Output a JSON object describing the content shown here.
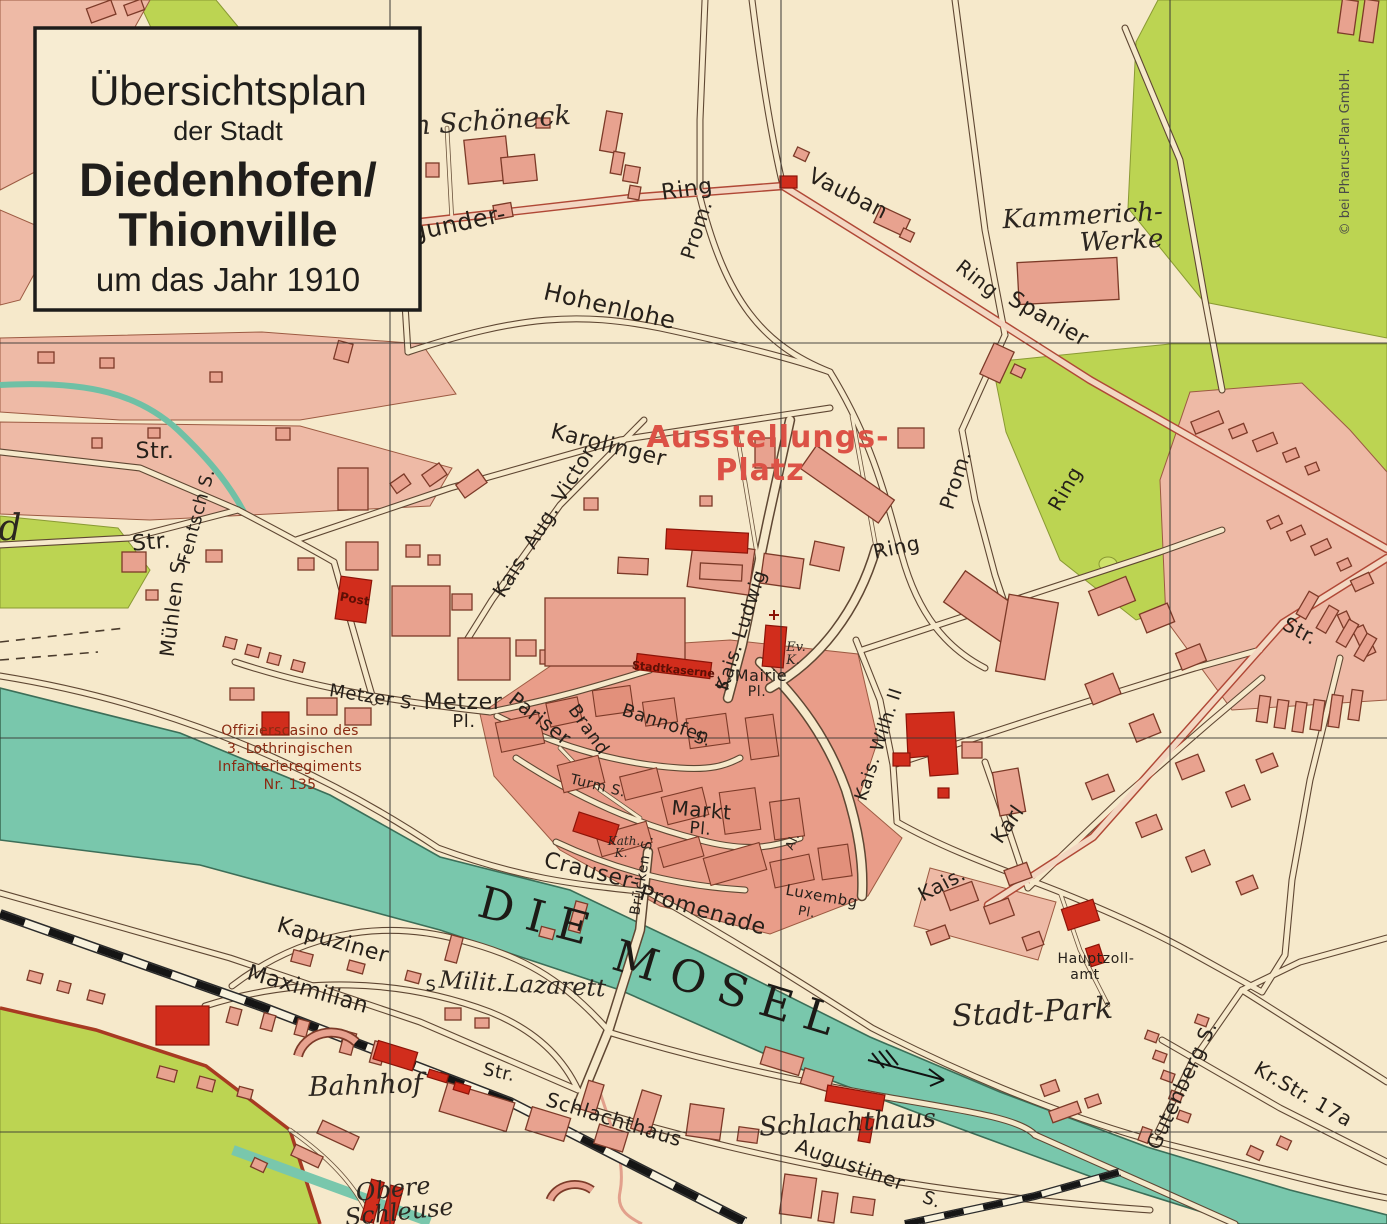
{
  "map_title_box": {
    "line1": "Übersichtsplan",
    "line2": "der Stadt",
    "line3": "Diedenhofen/",
    "line4": "Thionville",
    "line5": "um das Jahr 1910"
  },
  "copyright": "© bei Pharus-Plan GmbH.",
  "colors": {
    "paper": "#f6e9cb",
    "district_pink": "#eebaa6",
    "old_town": "#e99d89",
    "building_salmon": "#e8a28f",
    "building_red": "#d12d1c",
    "park_green": "#bcd452",
    "river_teal": "#79c7ac",
    "main_road_red": "#b04836",
    "red_label": "#dc5246",
    "script_red": "#8a2a12"
  },
  "river_name": "DIE MOSEL",
  "labels": [
    {
      "t": "Im Schöneck",
      "x": 483,
      "y": 130,
      "r": -4,
      "s": 27,
      "st": "se"
    },
    {
      "t": "gunder-",
      "x": 460,
      "y": 231,
      "r": -12,
      "s": 24,
      "st": "st"
    },
    {
      "t": "Ring",
      "x": 688,
      "y": 196,
      "r": -8,
      "s": 22,
      "st": "st"
    },
    {
      "t": "Prom.",
      "x": 703,
      "y": 232,
      "r": -72,
      "s": 20,
      "st": "st"
    },
    {
      "t": "Vauban",
      "x": 845,
      "y": 200,
      "r": 27,
      "s": 22,
      "st": "st"
    },
    {
      "t": "Ring",
      "x": 973,
      "y": 284,
      "r": 38,
      "s": 20,
      "st": "st"
    },
    {
      "t": "Spanier",
      "x": 1045,
      "y": 325,
      "r": 30,
      "s": 22,
      "st": "st"
    },
    {
      "t": "Kammerich-",
      "x": 1083,
      "y": 224,
      "r": -3,
      "s": 26,
      "st": "se"
    },
    {
      "t": "Werke",
      "x": 1122,
      "y": 249,
      "r": -3,
      "s": 26,
      "st": "se"
    },
    {
      "t": "Hohenlohe",
      "x": 608,
      "y": 314,
      "r": 13,
      "s": 24,
      "st": "st"
    },
    {
      "t": "Karolinger",
      "x": 607,
      "y": 452,
      "r": 14,
      "s": 22,
      "st": "st"
    },
    {
      "t": "Kais. Aug. Victor.",
      "x": 551,
      "y": 523,
      "r": -58,
      "s": 20,
      "st": "st"
    },
    {
      "t": "Ausstellungs-",
      "x": 768,
      "y": 447,
      "r": 0,
      "s": 30,
      "st": "rd"
    },
    {
      "t": "Platz",
      "x": 760,
      "y": 480,
      "r": 0,
      "s": 30,
      "st": "rd"
    },
    {
      "t": "Prom.",
      "x": 962,
      "y": 482,
      "r": -72,
      "s": 20,
      "st": "st"
    },
    {
      "t": "Ring",
      "x": 898,
      "y": 554,
      "r": -12,
      "s": 20,
      "st": "st"
    },
    {
      "t": "Ring",
      "x": 1071,
      "y": 492,
      "r": -60,
      "s": 20,
      "st": "st"
    },
    {
      "t": "Str.",
      "x": 155,
      "y": 458,
      "r": 0,
      "s": 22,
      "st": "st"
    },
    {
      "t": "Str.",
      "x": 152,
      "y": 549,
      "r": -5,
      "s": 22,
      "st": "st"
    },
    {
      "t": "Fentsch S.",
      "x": 202,
      "y": 518,
      "r": -75,
      "s": 18,
      "st": "st"
    },
    {
      "t": "Mühlen S.",
      "x": 180,
      "y": 606,
      "r": -83,
      "s": 20,
      "st": "st"
    },
    {
      "t": "Post",
      "x": 354,
      "y": 603,
      "r": 10,
      "s": 12,
      "st": "rb"
    },
    {
      "t": "Metzer S.",
      "x": 373,
      "y": 703,
      "r": 9,
      "s": 18,
      "st": "st"
    },
    {
      "t": "Metzer",
      "x": 463,
      "y": 709,
      "r": 0,
      "s": 22,
      "st": "st"
    },
    {
      "t": "Pl.",
      "x": 464,
      "y": 727,
      "r": 0,
      "s": 18,
      "st": "st"
    },
    {
      "t": "Pariser",
      "x": 536,
      "y": 724,
      "r": 38,
      "s": 20,
      "st": "st"
    },
    {
      "t": "Brand",
      "x": 584,
      "y": 733,
      "r": 55,
      "s": 18,
      "st": "st"
    },
    {
      "t": "Stadtkaserne",
      "x": 673,
      "y": 673,
      "r": 6,
      "s": 11,
      "st": "rb"
    },
    {
      "t": "Kais. Ludwig",
      "x": 747,
      "y": 632,
      "r": -72,
      "s": 19,
      "st": "st"
    },
    {
      "t": "S.",
      "x": 729,
      "y": 684,
      "r": -72,
      "s": 16,
      "st": "st"
    },
    {
      "t": "Mairie",
      "x": 761,
      "y": 681,
      "r": 0,
      "s": 16,
      "st": "st"
    },
    {
      "t": "Pl.",
      "x": 757,
      "y": 696,
      "r": 0,
      "s": 14,
      "st": "st"
    },
    {
      "t": "Ev.",
      "x": 796,
      "y": 651,
      "r": 0,
      "s": 13,
      "st": "se"
    },
    {
      "t": "K.",
      "x": 793,
      "y": 664,
      "r": 0,
      "s": 13,
      "st": "se"
    },
    {
      "t": "Bannofen",
      "x": 664,
      "y": 729,
      "r": 18,
      "s": 18,
      "st": "st"
    },
    {
      "t": "S.",
      "x": 701,
      "y": 744,
      "r": 18,
      "s": 16,
      "st": "st"
    },
    {
      "t": "Markt",
      "x": 701,
      "y": 817,
      "r": 5,
      "s": 20,
      "st": "st"
    },
    {
      "t": "Pl.",
      "x": 700,
      "y": 834,
      "r": 5,
      "s": 17,
      "st": "st"
    },
    {
      "t": "Turm S.",
      "x": 597,
      "y": 790,
      "r": 14,
      "s": 14,
      "st": "st"
    },
    {
      "t": "Kath.",
      "x": 624,
      "y": 845,
      "r": 0,
      "s": 12,
      "st": "se"
    },
    {
      "t": "K.",
      "x": 621,
      "y": 857,
      "r": 0,
      "s": 12,
      "st": "se"
    },
    {
      "t": "Brücken S.",
      "x": 646,
      "y": 876,
      "r": -80,
      "s": 14,
      "st": "st"
    },
    {
      "t": "Crauser-",
      "x": 590,
      "y": 878,
      "r": 14,
      "s": 22,
      "st": "st"
    },
    {
      "t": "Promenade",
      "x": 701,
      "y": 917,
      "r": 16,
      "s": 22,
      "st": "st"
    },
    {
      "t": "DIE",
      "x": 537,
      "y": 932,
      "r": 15,
      "s": 44,
      "st": "ri"
    },
    {
      "t": "MOSEL",
      "x": 726,
      "y": 1004,
      "r": 17,
      "s": 44,
      "st": "ri"
    },
    {
      "t": "Luxembg",
      "x": 821,
      "y": 901,
      "r": 10,
      "s": 15,
      "st": "st"
    },
    {
      "t": "Pl.",
      "x": 806,
      "y": 916,
      "r": 10,
      "s": 13,
      "st": "st"
    },
    {
      "t": "Al.",
      "x": 796,
      "y": 843,
      "r": -65,
      "s": 12,
      "st": "st"
    },
    {
      "t": "Kais. Wilh. II",
      "x": 884,
      "y": 746,
      "r": -72,
      "s": 18,
      "st": "st"
    },
    {
      "t": "Kais.",
      "x": 945,
      "y": 890,
      "r": -28,
      "s": 20,
      "st": "st"
    },
    {
      "t": "Karl",
      "x": 1013,
      "y": 828,
      "r": -55,
      "s": 20,
      "st": "st"
    },
    {
      "t": "Str.",
      "x": 1297,
      "y": 637,
      "r": 28,
      "s": 20,
      "st": "st"
    },
    {
      "t": "Hauptzoll-",
      "x": 1096,
      "y": 963,
      "r": 0,
      "s": 14,
      "st": "st"
    },
    {
      "t": "amt",
      "x": 1085,
      "y": 979,
      "r": 0,
      "s": 14,
      "st": "st"
    },
    {
      "t": "Stadt-Park",
      "x": 1033,
      "y": 1022,
      "r": -3,
      "s": 30,
      "st": "se"
    },
    {
      "t": "Gutenberg S.",
      "x": 1188,
      "y": 1088,
      "r": -65,
      "s": 20,
      "st": "st"
    },
    {
      "t": "Kr.Str. 17a",
      "x": 1300,
      "y": 1100,
      "r": 30,
      "s": 20,
      "st": "st"
    },
    {
      "t": "Kapuziner",
      "x": 331,
      "y": 947,
      "r": 16,
      "s": 22,
      "st": "st"
    },
    {
      "t": "Maximilian",
      "x": 306,
      "y": 996,
      "r": 16,
      "s": 22,
      "st": "st"
    },
    {
      "t": "S",
      "x": 431,
      "y": 991,
      "r": 0,
      "s": 16,
      "st": "st"
    },
    {
      "t": "Milit.Lazarett",
      "x": 522,
      "y": 992,
      "r": 3,
      "s": 24,
      "st": "se"
    },
    {
      "t": "Str.",
      "x": 498,
      "y": 1078,
      "r": 12,
      "s": 18,
      "st": "st"
    },
    {
      "t": "Bahnhof",
      "x": 366,
      "y": 1094,
      "r": -2,
      "s": 27,
      "st": "se"
    },
    {
      "t": "Schlachthaus",
      "x": 612,
      "y": 1126,
      "r": 17,
      "s": 20,
      "st": "st"
    },
    {
      "t": "Schlachthaus",
      "x": 848,
      "y": 1131,
      "r": -3,
      "s": 26,
      "st": "se"
    },
    {
      "t": "Augustiner",
      "x": 848,
      "y": 1171,
      "r": 20,
      "s": 20,
      "st": "st"
    },
    {
      "t": "S.",
      "x": 930,
      "y": 1205,
      "r": 20,
      "s": 18,
      "st": "st"
    },
    {
      "t": "Obere",
      "x": 394,
      "y": 1197,
      "r": -6,
      "s": 24,
      "st": "se"
    },
    {
      "t": "Schleuse",
      "x": 400,
      "y": 1220,
      "r": -6,
      "s": 24,
      "st": "se"
    },
    {
      "t": "d",
      "x": 10,
      "y": 540,
      "r": 0,
      "s": 36,
      "st": "se"
    },
    {
      "t": "Offizierscasino des",
      "x": 290,
      "y": 735,
      "r": 0,
      "s": 14,
      "st": "sc",
      "a": "start"
    },
    {
      "t": "3. Lothringischen",
      "x": 290,
      "y": 753,
      "r": 0,
      "s": 14,
      "st": "sc",
      "a": "start"
    },
    {
      "t": "Infanterieregiments",
      "x": 290,
      "y": 771,
      "r": 0,
      "s": 14,
      "st": "sc",
      "a": "start"
    },
    {
      "t": "Nr. 135",
      "x": 290,
      "y": 789,
      "r": 0,
      "s": 14,
      "st": "sc",
      "a": "start"
    },
    {
      "t": "© bei Pharus-Plan GmbH.",
      "x": 1349,
      "y": 152,
      "r": -90,
      "s": 13,
      "st": "cp",
      "n": "copyright-text"
    }
  ]
}
